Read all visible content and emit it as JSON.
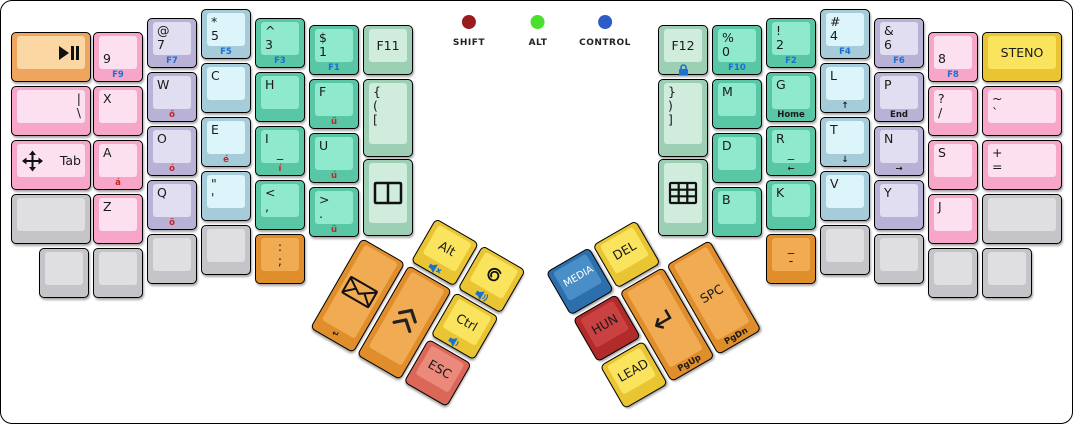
{
  "colors": {
    "pink": {
      "base": "#f7a6c9",
      "top": "#fde0f0"
    },
    "lavender": {
      "base": "#b9b1d6",
      "top": "#e2def1"
    },
    "cyan": {
      "base": "#a6cbd9",
      "top": "#dbf5fb"
    },
    "green": {
      "base": "#59c7a6",
      "top": "#8fe9cd"
    },
    "lightgreen": {
      "base": "#9ccfb4",
      "top": "#cfecdc"
    },
    "gray": {
      "base": "#c4c4c9",
      "top": "#dfdfe2"
    },
    "orange": {
      "base": "#e08e2b",
      "top": "#f1ab53"
    },
    "softorange": {
      "base": "#f0a55f",
      "top": "#fad7a3"
    },
    "yellow": {
      "base": "#e9c433",
      "top": "#fae45e"
    },
    "salmon": {
      "base": "#da6758",
      "top": "#eb897a"
    },
    "crimson": {
      "base": "#b12b2b",
      "top": "#ca4141"
    },
    "blue": {
      "base": "#2d6fad",
      "top": "#4a8ec7"
    }
  },
  "front_colors": {
    "blue": "#1a6fd0",
    "red": "#c42525",
    "black": "#1a1a1a"
  },
  "indicators": [
    {
      "name": "shift",
      "label": "SHIFT",
      "x": 468,
      "color": "#9b1c1c"
    },
    {
      "name": "alt",
      "label": "ALT",
      "x": 537,
      "color": "#4be02e"
    },
    {
      "name": "control",
      "label": "CONTROL",
      "x": 604,
      "color": "#2c5cc5"
    }
  ],
  "keys": [
    {
      "name": "key-play-pause",
      "x": 10,
      "y": 31,
      "w": 80,
      "color": "softorange",
      "icon": "play-pause",
      "ipos": "r"
    },
    {
      "name": "key-pipe-backslash",
      "x": 10,
      "y": 85,
      "w": 80,
      "color": "pink",
      "rows": [
        {
          "t": "|",
          "a": "r"
        },
        {
          "t": "\\",
          "a": "r"
        }
      ]
    },
    {
      "name": "key-tab",
      "x": 10,
      "y": 139,
      "w": 80,
      "color": "pink",
      "ctr": true,
      "rows": [
        {
          "t": "Tab",
          "a": "r"
        }
      ],
      "icon": "move",
      "ipos": "l"
    },
    {
      "name": "key-blank-left-row4",
      "x": 10,
      "y": 193,
      "w": 80,
      "color": "gray"
    },
    {
      "name": "key-9",
      "x": 92,
      "y": 31,
      "color": "pink",
      "rows": [
        {
          "t": ""
        },
        {
          "t": "9"
        }
      ],
      "front": {
        "t": "F9",
        "c": "blue"
      }
    },
    {
      "name": "key-x",
      "x": 92,
      "y": 85,
      "color": "pink",
      "rows": [
        {
          "t": "X"
        }
      ]
    },
    {
      "name": "key-a",
      "x": 92,
      "y": 139,
      "color": "pink",
      "rows": [
        {
          "t": "A"
        }
      ],
      "front": {
        "t": "á",
        "c": "red"
      }
    },
    {
      "name": "key-z",
      "x": 92,
      "y": 193,
      "color": "pink",
      "rows": [
        {
          "t": "Z"
        }
      ]
    },
    {
      "name": "key-at-7",
      "x": 146,
      "y": 17,
      "color": "lavender",
      "rows": [
        {
          "t": "@"
        },
        {
          "t": "7"
        }
      ],
      "front": {
        "t": "F7",
        "c": "blue"
      }
    },
    {
      "name": "key-w",
      "x": 146,
      "y": 71,
      "color": "lavender",
      "rows": [
        {
          "t": "W"
        }
      ],
      "front": {
        "t": "ő",
        "c": "red"
      }
    },
    {
      "name": "key-o",
      "x": 146,
      "y": 125,
      "color": "lavender",
      "rows": [
        {
          "t": "O"
        }
      ],
      "front": {
        "t": "ó",
        "c": "red"
      }
    },
    {
      "name": "key-q",
      "x": 146,
      "y": 179,
      "color": "lavender",
      "rows": [
        {
          "t": "Q"
        }
      ],
      "front": {
        "t": "ö",
        "c": "red"
      }
    },
    {
      "name": "key-star-5",
      "x": 200,
      "y": 8,
      "color": "cyan",
      "rows": [
        {
          "t": "*"
        },
        {
          "t": "5"
        }
      ],
      "front": {
        "t": "F5",
        "c": "blue"
      }
    },
    {
      "name": "key-c",
      "x": 200,
      "y": 62,
      "color": "cyan",
      "rows": [
        {
          "t": "C"
        }
      ]
    },
    {
      "name": "key-e",
      "x": 200,
      "y": 116,
      "color": "cyan",
      "rows": [
        {
          "t": "E"
        }
      ],
      "front": {
        "t": "é",
        "c": "red"
      }
    },
    {
      "name": "key-quote",
      "x": 200,
      "y": 170,
      "color": "cyan",
      "rows": [
        {
          "t": "\""
        },
        {
          "t": "'"
        }
      ]
    },
    {
      "name": "key-caret-3",
      "x": 254,
      "y": 17,
      "color": "green",
      "rows": [
        {
          "t": "^"
        },
        {
          "t": "3"
        }
      ],
      "front": {
        "t": "F3",
        "c": "blue"
      }
    },
    {
      "name": "key-h",
      "x": 254,
      "y": 71,
      "color": "green",
      "rows": [
        {
          "t": "H"
        }
      ]
    },
    {
      "name": "key-i",
      "x": 254,
      "y": 125,
      "color": "green",
      "rows": [
        {
          "t": "I"
        },
        {
          "t": "_",
          "a": "c"
        }
      ],
      "front": {
        "t": "í",
        "c": "red"
      }
    },
    {
      "name": "key-lt-comma",
      "x": 254,
      "y": 179,
      "color": "green",
      "rows": [
        {
          "t": "<"
        },
        {
          "t": ","
        }
      ]
    },
    {
      "name": "key-dollar-1",
      "x": 308,
      "y": 24,
      "color": "green",
      "rows": [
        {
          "t": "$"
        },
        {
          "t": "1"
        }
      ],
      "front": {
        "t": "F1",
        "c": "blue"
      }
    },
    {
      "name": "key-f",
      "x": 308,
      "y": 78,
      "color": "green",
      "rows": [
        {
          "t": "F"
        }
      ],
      "front": {
        "t": "ű",
        "c": "red"
      }
    },
    {
      "name": "key-u",
      "x": 308,
      "y": 132,
      "color": "green",
      "rows": [
        {
          "t": "U"
        }
      ],
      "front": {
        "t": "ú",
        "c": "red"
      }
    },
    {
      "name": "key-gt-period",
      "x": 308,
      "y": 186,
      "color": "green",
      "rows": [
        {
          "t": ">"
        },
        {
          "t": "."
        }
      ],
      "front": {
        "t": "ü",
        "c": "red"
      }
    },
    {
      "name": "key-f11",
      "x": 362,
      "y": 24,
      "color": "lightgreen",
      "ctr": true,
      "rows": [
        {
          "t": "F11"
        }
      ]
    },
    {
      "name": "key-brace-open",
      "x": 362,
      "y": 78,
      "h": 78,
      "color": "lightgreen",
      "rows": [
        {
          "t": "{"
        },
        {
          "t": "("
        },
        {
          "t": "["
        }
      ]
    },
    {
      "name": "key-split-layout",
      "x": 362,
      "y": 158,
      "h": 77,
      "color": "lightgreen",
      "icon": "split"
    },
    {
      "name": "key-blank-bl-1",
      "x": 38,
      "y": 247,
      "color": "gray"
    },
    {
      "name": "key-blank-bl-2",
      "x": 92,
      "y": 247,
      "color": "gray"
    },
    {
      "name": "key-blank-bl-3",
      "x": 146,
      "y": 233,
      "color": "gray"
    },
    {
      "name": "key-blank-bl-4",
      "x": 200,
      "y": 224,
      "color": "gray"
    },
    {
      "name": "key-colon-semicolon",
      "x": 254,
      "y": 233,
      "color": "orange",
      "rows": [
        {
          "t": ":",
          "a": "c"
        },
        {
          "t": ";",
          "a": "c"
        }
      ]
    },
    {
      "name": "key-f12",
      "x": 657,
      "y": 24,
      "color": "lightgreen",
      "ctr": true,
      "rows": [
        {
          "t": "F12"
        }
      ],
      "front": {
        "i": "lock",
        "c": "blue"
      }
    },
    {
      "name": "key-brace-close",
      "x": 657,
      "y": 78,
      "h": 78,
      "color": "lightgreen",
      "rows": [
        {
          "t": "}"
        },
        {
          "t": ")"
        },
        {
          "t": "]"
        }
      ]
    },
    {
      "name": "key-keypad-layout",
      "x": 657,
      "y": 158,
      "h": 77,
      "color": "lightgreen",
      "icon": "grid"
    },
    {
      "name": "key-pct-0",
      "x": 711,
      "y": 24,
      "color": "green",
      "rows": [
        {
          "t": "%"
        },
        {
          "t": "0"
        }
      ],
      "front": {
        "t": "F10",
        "c": "blue"
      }
    },
    {
      "name": "key-m",
      "x": 711,
      "y": 78,
      "color": "green",
      "rows": [
        {
          "t": "M"
        }
      ]
    },
    {
      "name": "key-d",
      "x": 711,
      "y": 132,
      "color": "green",
      "rows": [
        {
          "t": "D"
        }
      ]
    },
    {
      "name": "key-b",
      "x": 711,
      "y": 186,
      "color": "green",
      "rows": [
        {
          "t": "B"
        }
      ]
    },
    {
      "name": "key-excl-2",
      "x": 765,
      "y": 17,
      "color": "green",
      "rows": [
        {
          "t": "!"
        },
        {
          "t": "2"
        }
      ],
      "front": {
        "t": "F2",
        "c": "blue"
      }
    },
    {
      "name": "key-g",
      "x": 765,
      "y": 71,
      "color": "green",
      "rows": [
        {
          "t": "G"
        }
      ],
      "front": {
        "t": "Home",
        "c": "black"
      }
    },
    {
      "name": "key-r",
      "x": 765,
      "y": 125,
      "color": "green",
      "rows": [
        {
          "t": "R"
        },
        {
          "t": "_",
          "a": "c"
        }
      ],
      "front": {
        "t": "←",
        "c": "black"
      }
    },
    {
      "name": "key-k",
      "x": 765,
      "y": 179,
      "color": "green",
      "rows": [
        {
          "t": "K"
        }
      ]
    },
    {
      "name": "key-hash-4",
      "x": 819,
      "y": 8,
      "color": "cyan",
      "rows": [
        {
          "t": "#"
        },
        {
          "t": "4"
        }
      ],
      "front": {
        "t": "F4",
        "c": "blue"
      }
    },
    {
      "name": "key-l",
      "x": 819,
      "y": 62,
      "color": "cyan",
      "rows": [
        {
          "t": "L"
        }
      ],
      "front": {
        "t": "↑",
        "c": "black"
      }
    },
    {
      "name": "key-t",
      "x": 819,
      "y": 116,
      "color": "cyan",
      "rows": [
        {
          "t": "T"
        }
      ],
      "front": {
        "t": "↓",
        "c": "black"
      }
    },
    {
      "name": "key-v",
      "x": 819,
      "y": 170,
      "color": "cyan",
      "rows": [
        {
          "t": "V"
        }
      ]
    },
    {
      "name": "key-amp-6",
      "x": 873,
      "y": 17,
      "color": "lavender",
      "rows": [
        {
          "t": "&"
        },
        {
          "t": "6"
        }
      ],
      "front": {
        "t": "F6",
        "c": "blue"
      }
    },
    {
      "name": "key-p",
      "x": 873,
      "y": 71,
      "color": "lavender",
      "rows": [
        {
          "t": "P"
        }
      ],
      "front": {
        "t": "End",
        "c": "black"
      }
    },
    {
      "name": "key-n",
      "x": 873,
      "y": 125,
      "color": "lavender",
      "rows": [
        {
          "t": "N"
        }
      ],
      "front": {
        "t": "→",
        "c": "black"
      }
    },
    {
      "name": "key-y",
      "x": 873,
      "y": 179,
      "color": "lavender",
      "rows": [
        {
          "t": "Y"
        }
      ]
    },
    {
      "name": "key-8",
      "x": 927,
      "y": 31,
      "color": "pink",
      "rows": [
        {
          "t": ""
        },
        {
          "t": "8"
        }
      ],
      "front": {
        "t": "F8",
        "c": "blue"
      }
    },
    {
      "name": "key-question-slash",
      "x": 927,
      "y": 85,
      "color": "pink",
      "rows": [
        {
          "t": "?"
        },
        {
          "t": "/"
        }
      ]
    },
    {
      "name": "key-s",
      "x": 927,
      "y": 139,
      "color": "pink",
      "rows": [
        {
          "t": "S"
        }
      ]
    },
    {
      "name": "key-j",
      "x": 927,
      "y": 193,
      "color": "pink",
      "rows": [
        {
          "t": "J"
        }
      ]
    },
    {
      "name": "key-steno",
      "x": 981,
      "y": 31,
      "w": 80,
      "color": "yellow",
      "ctr": true,
      "rows": [
        {
          "t": "STENO"
        }
      ]
    },
    {
      "name": "key-tilde-backtick",
      "x": 981,
      "y": 85,
      "w": 80,
      "color": "pink",
      "rows": [
        {
          "t": "~"
        },
        {
          "t": "`"
        }
      ]
    },
    {
      "name": "key-plus-equals",
      "x": 981,
      "y": 139,
      "w": 80,
      "color": "pink",
      "rows": [
        {
          "t": "+"
        },
        {
          "t": "="
        }
      ]
    },
    {
      "name": "key-blank-right-row4",
      "x": 981,
      "y": 193,
      "w": 80,
      "color": "gray"
    },
    {
      "name": "key-underscore-dash",
      "x": 765,
      "y": 233,
      "color": "orange",
      "rows": [
        {
          "t": "_",
          "a": "c"
        },
        {
          "t": "-",
          "a": "c"
        }
      ]
    },
    {
      "name": "key-blank-br-1",
      "x": 819,
      "y": 224,
      "color": "gray"
    },
    {
      "name": "key-blank-br-2",
      "x": 873,
      "y": 233,
      "color": "gray"
    },
    {
      "name": "key-blank-br-3",
      "x": 927,
      "y": 247,
      "color": "gray"
    },
    {
      "name": "key-blank-br-4",
      "x": 981,
      "y": 247,
      "color": "gray"
    }
  ],
  "thumb_clusters": [
    {
      "name": "left-thumb-cluster",
      "pivot_x": 361,
      "pivot_y": 237,
      "rotation": 30,
      "keys": [
        {
          "name": "key-alt",
          "x": 54,
          "y": -54,
          "color": "yellow",
          "ctr": true,
          "rows": [
            {
              "t": "Alt"
            }
          ],
          "front": {
            "i": "mute",
            "c": "blue"
          }
        },
        {
          "name": "key-debian",
          "x": 108,
          "y": -54,
          "color": "yellow",
          "icon": "debian",
          "front": {
            "i": "vol-up",
            "c": "blue"
          }
        },
        {
          "name": "key-email",
          "x": 0,
          "y": 0,
          "h": 104,
          "color": "orange",
          "icon": "envelope",
          "front": {
            "t": "↵",
            "c": "black"
          }
        },
        {
          "name": "key-shift-chevrons",
          "x": 54,
          "y": 0,
          "h": 104,
          "color": "orange",
          "icon": "chevrons"
        },
        {
          "name": "key-ctrl",
          "x": 108,
          "y": 0,
          "color": "yellow",
          "ctr": true,
          "rows": [
            {
              "t": "Ctrl"
            }
          ],
          "front": {
            "i": "vol-down",
            "c": "blue"
          }
        },
        {
          "name": "key-esc",
          "x": 108,
          "y": 54,
          "color": "salmon",
          "ctr": true,
          "rows": [
            {
              "t": "ESC"
            }
          ]
        }
      ]
    },
    {
      "name": "right-thumb-cluster",
      "pivot_x": 712,
      "pivot_y": 237,
      "rotation": -30,
      "keys": [
        {
          "name": "key-media",
          "x": -162,
          "y": -54,
          "color": "blue",
          "ctr": true,
          "tc": "#ffffff",
          "fs": 10,
          "rows": [
            {
              "t": "MEDIA"
            }
          ]
        },
        {
          "name": "key-del",
          "x": -108,
          "y": -54,
          "color": "yellow",
          "ctr": true,
          "rows": [
            {
              "t": "DEL"
            }
          ]
        },
        {
          "name": "key-hun",
          "x": -162,
          "y": 0,
          "color": "crimson",
          "ctr": true,
          "rows": [
            {
              "t": "HUN"
            }
          ]
        },
        {
          "name": "key-enter",
          "x": -108,
          "y": 0,
          "h": 104,
          "color": "orange",
          "ctr": true,
          "fs": 30,
          "rows": [
            {
              "t": "↵"
            }
          ],
          "front": {
            "t": "PgUp",
            "c": "black"
          }
        },
        {
          "name": "key-spc",
          "x": -54,
          "y": 0,
          "h": 104,
          "color": "orange",
          "ctr": true,
          "rows": [
            {
              "t": "SPC"
            }
          ],
          "front": {
            "t": "PgDn",
            "c": "black"
          }
        },
        {
          "name": "key-lead",
          "x": -162,
          "y": 54,
          "color": "yellow",
          "ctr": true,
          "rows": [
            {
              "t": "LEAD"
            }
          ]
        }
      ]
    }
  ]
}
